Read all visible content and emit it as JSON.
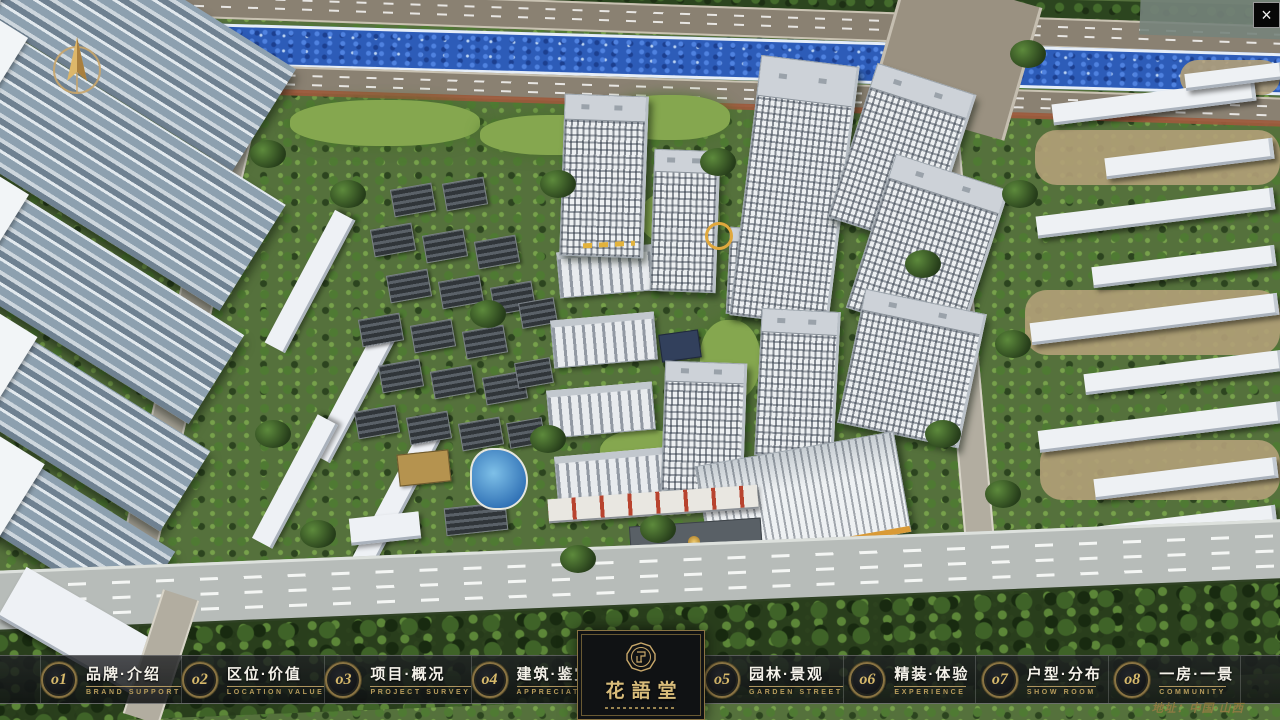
{
  "icons": {
    "close": "×"
  },
  "logo": {
    "title": "花語堂"
  },
  "nav": {
    "items": [
      {
        "num": "o1",
        "zh": "品牌·介绍",
        "en": "BRAND SUPPORT"
      },
      {
        "num": "o2",
        "zh": "区位·价值",
        "en": "LOCATION VALUE"
      },
      {
        "num": "o3",
        "zh": "项目·概况",
        "en": "PROJECT SURVEY"
      },
      {
        "num": "o4",
        "zh": "建筑·鉴赏",
        "en": "APPRECIATION"
      },
      {
        "num": "o5",
        "zh": "园林·景观",
        "en": "GARDEN STREET"
      },
      {
        "num": "o6",
        "zh": "精装·体验",
        "en": "EXPERIENCE"
      },
      {
        "num": "o7",
        "zh": "户型·分布",
        "en": "SHOW ROOM"
      },
      {
        "num": "o8",
        "zh": "一房·一景",
        "en": "COMMUNITY"
      }
    ]
  },
  "footer": {
    "address": "地址：中国·山西"
  },
  "colors": {
    "gold": "#c9a96a",
    "gold_dark": "#8a7443",
    "bar_bg": "rgba(18,20,23,0.8)",
    "river": "#2d5cb8",
    "tree_green": "#3b5a2a"
  }
}
